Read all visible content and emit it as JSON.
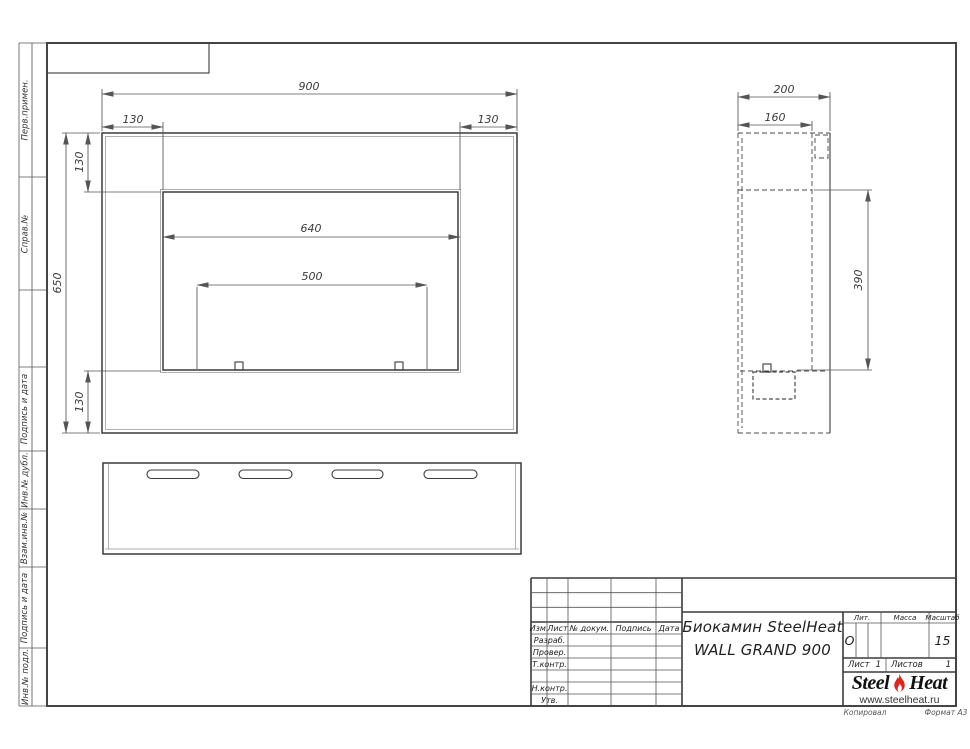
{
  "left_margin": {
    "labels": [
      "Перв.примен.",
      "Справ.№",
      "Подпись и дата",
      "Инв.№ дубл.",
      "Взам.инв.№",
      "Подпись и дата",
      "Инв.№ подл."
    ]
  },
  "dims": {
    "front": {
      "width": "900",
      "flange_left": "130",
      "flange_right": "130",
      "height": "650",
      "flange_top": "130",
      "flange_bottom": "130",
      "opening_width": "640",
      "mount_span": "500"
    },
    "side": {
      "depth": "200",
      "inner_depth": "160",
      "opening_height": "390"
    }
  },
  "title_block": {
    "header": {
      "izm": "Изм.",
      "list": "Лист",
      "doc": "№ докум.",
      "sign": "Подпись",
      "date": "Дата"
    },
    "roles": {
      "razrab": "Разраб.",
      "prover": "Провер.",
      "tkontr": "Т.контр.",
      "nkontr": "Н.контр.",
      "utv": "Утв."
    },
    "title_line1": "Биокамин SteelHeat",
    "title_line2": "WALL GRAND 900",
    "lit_label": "Лит.",
    "lit_value": "О",
    "mass_label": "Масса",
    "scale_label": "Масштаб",
    "scale_value": "15",
    "sheet_label": "Лист",
    "sheet_number": "1",
    "sheets_label": "Листов",
    "sheets_total": "1",
    "logo_part1": "Steel",
    "logo_part2": "Heat",
    "logo_url": "www.steelheat.ru",
    "footer_copy": "Копировал",
    "footer_format": "Формат А3"
  }
}
